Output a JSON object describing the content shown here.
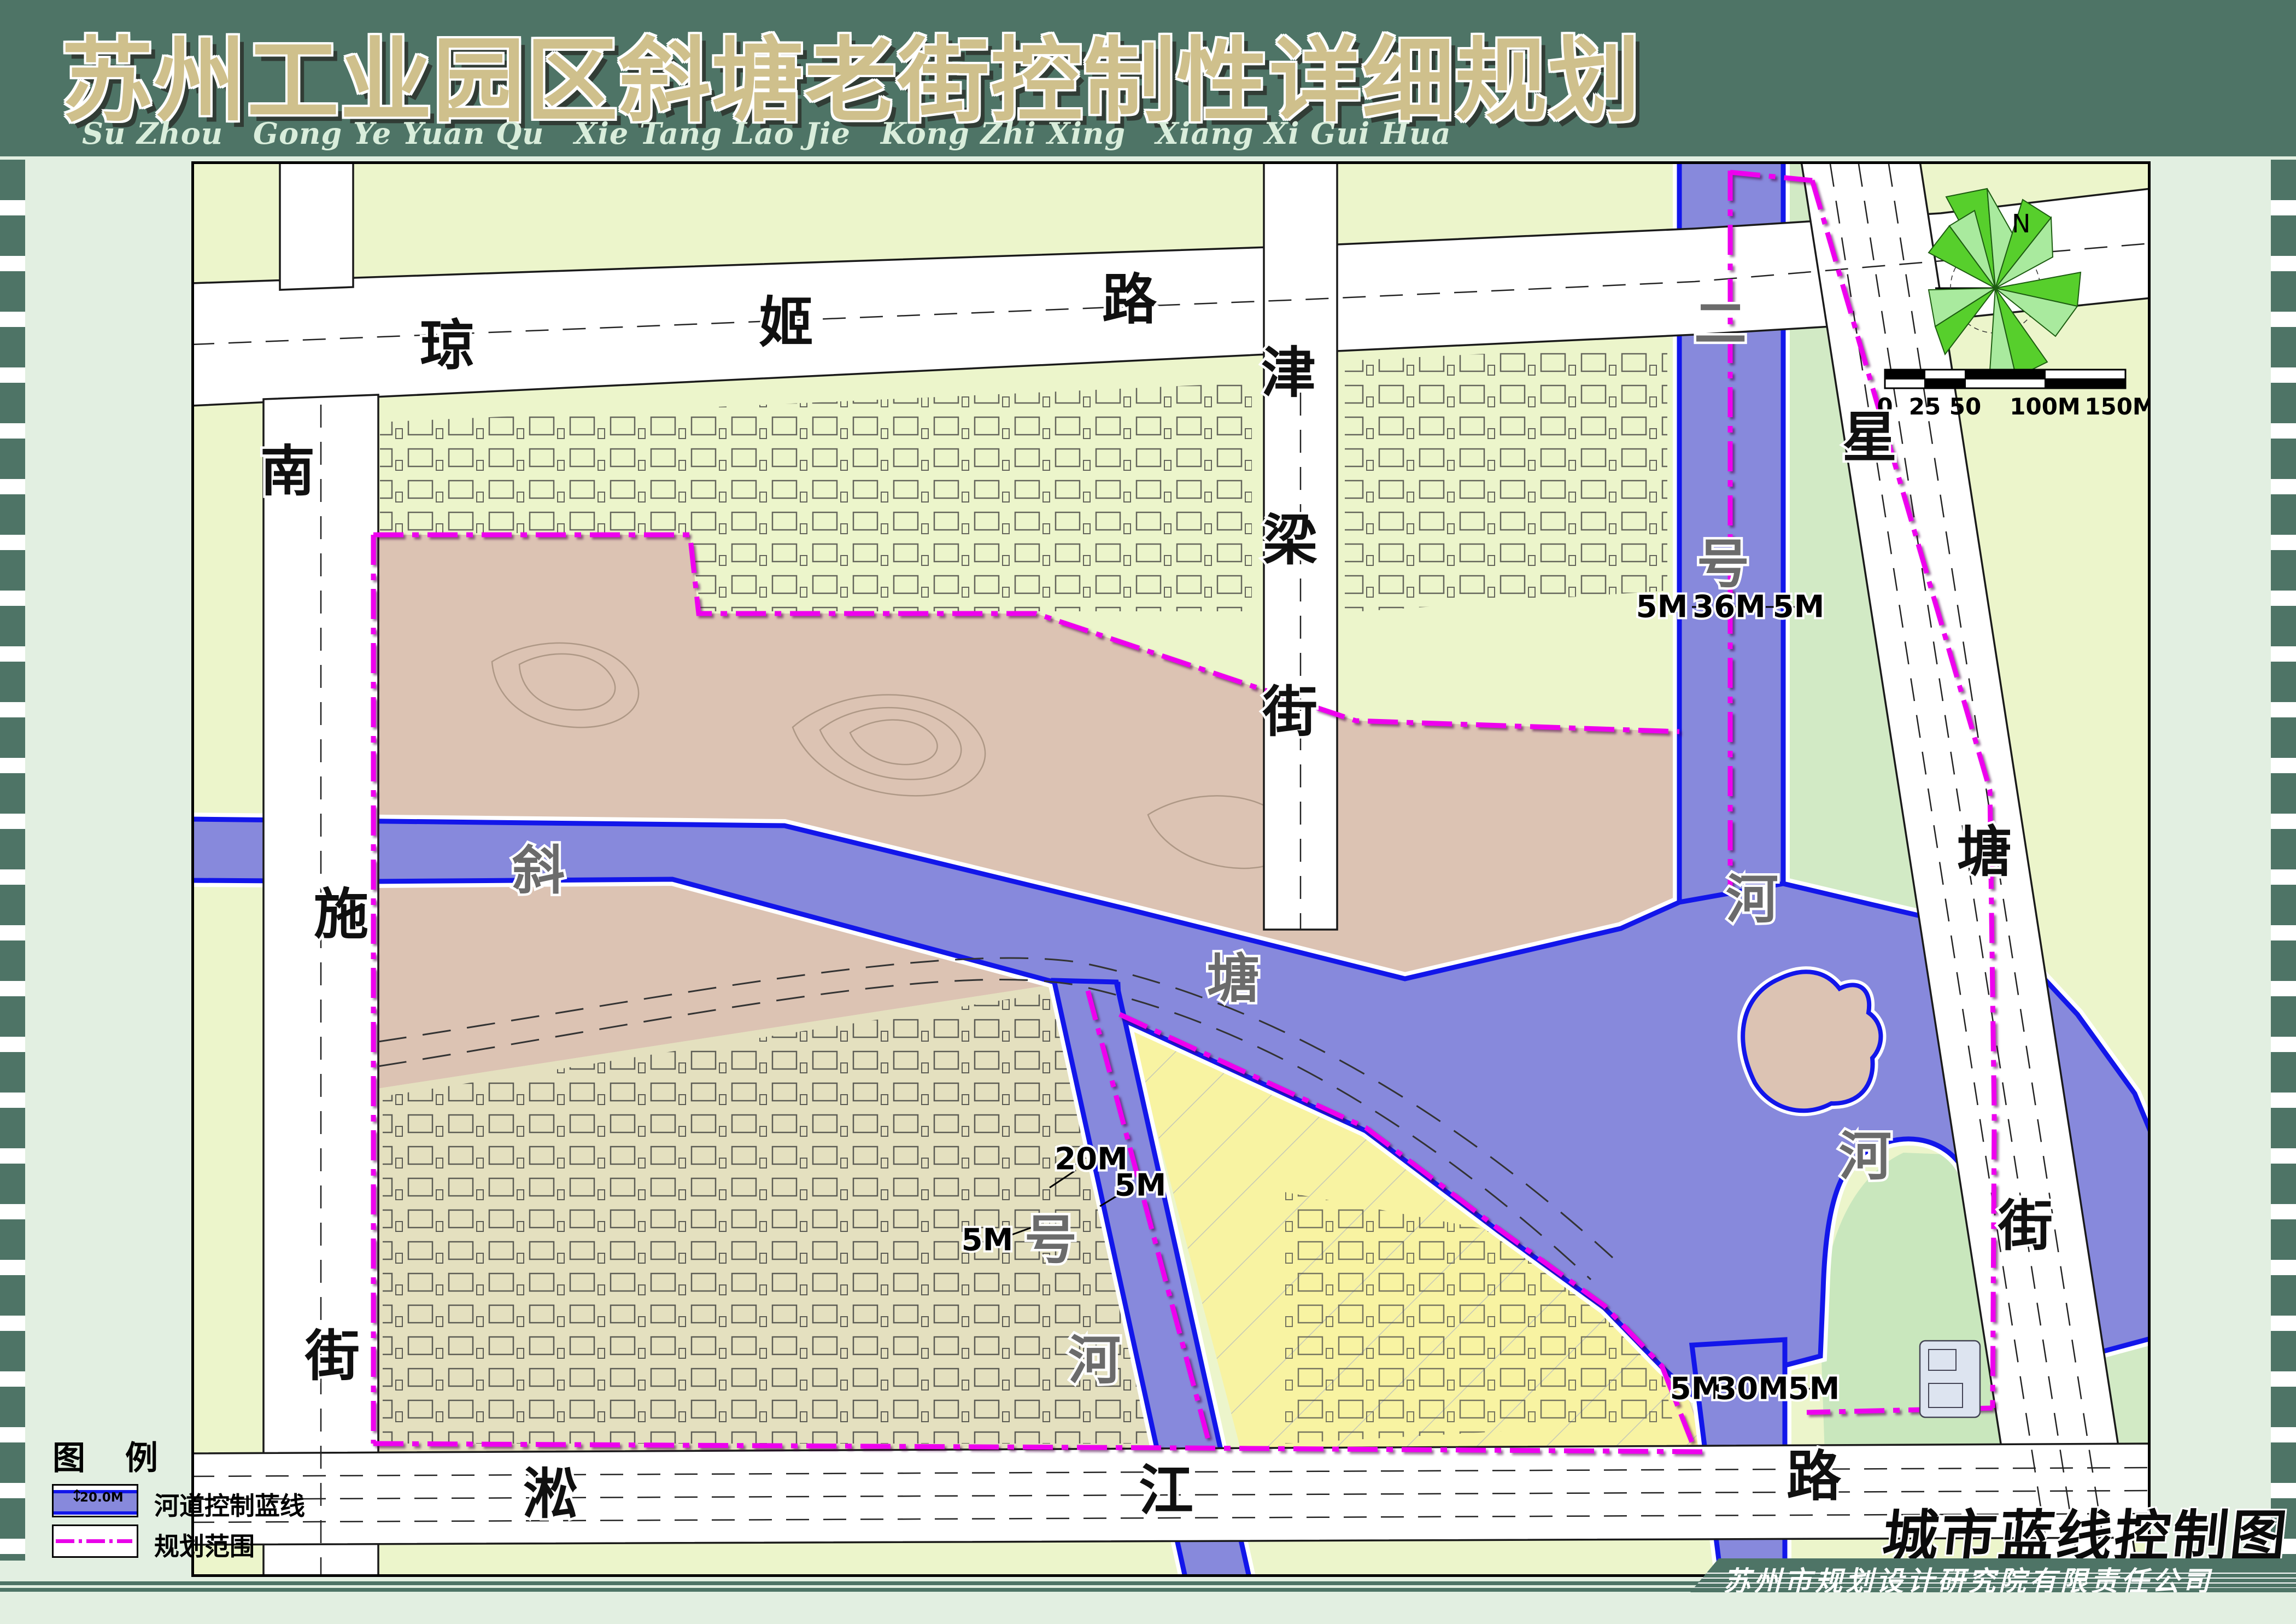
{
  "title": {
    "main": "苏州工业园区斜塘老街控制性详细规划",
    "pinyin": "Su Zhou Gong Ye Yuan Qu Xie Tang Lao Jie Kong Zhi Xing Xiang Xi Gui Hua"
  },
  "legend": {
    "title": "图 例",
    "items": [
      {
        "label": "河道控制蓝线",
        "swatch_text": "20.0M"
      },
      {
        "label": "规划范围"
      }
    ]
  },
  "footer": {
    "map_name": "城市蓝线控制图",
    "company": "苏州市规划设计研究院有限责任公司"
  },
  "compass": {
    "north_label": "N"
  },
  "scalebar": {
    "ticks": [
      "0",
      "25",
      "50",
      "100M",
      "150M"
    ]
  },
  "streets": {
    "qiongji": [
      "琼",
      "姬",
      "路"
    ],
    "nanshi": [
      "南",
      "施",
      "街"
    ],
    "jinliang": [
      "津",
      "梁",
      "街"
    ],
    "songjiang": [
      "淞",
      "江",
      "路"
    ],
    "xingtang": [
      "星",
      "塘",
      "街"
    ]
  },
  "rivers": {
    "xietang": [
      "斜",
      "塘",
      "河"
    ],
    "erhao": [
      "二",
      "号",
      "河"
    ],
    "yihao": [
      "号",
      "河"
    ]
  },
  "dimensions": {
    "erhao": [
      "5M",
      "36M",
      "5M"
    ],
    "yihao": [
      "20M",
      "5M",
      "5M"
    ],
    "exit": [
      "5M",
      "30M",
      "5M"
    ]
  },
  "colors": {
    "band_green": "#4e7466",
    "title_tan": "#cfc08c",
    "map_bg": "#ecf5cb",
    "planning_pink": "#dcc3b3",
    "old_town": "#e4e0bf",
    "residential_yellow": "#f8f3a2",
    "park_green": "#d2eac5",
    "water_fill": "#8789dc",
    "water_line": "#1216ea",
    "boundary_magenta": "#ee00ee"
  }
}
